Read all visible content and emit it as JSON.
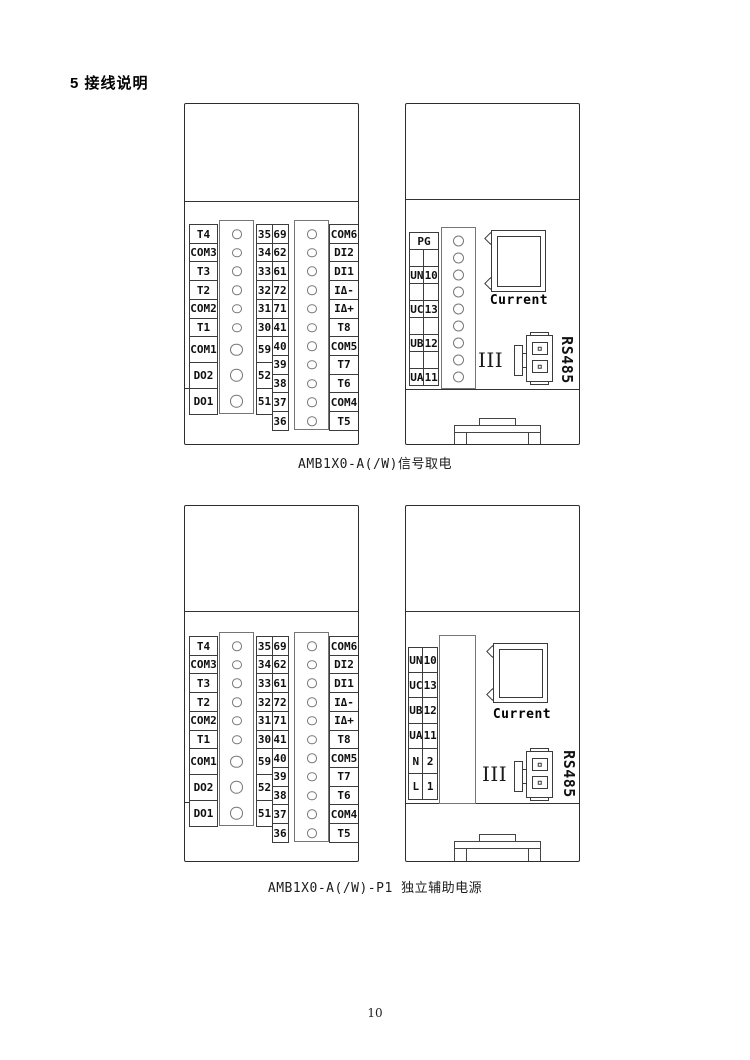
{
  "page": {
    "heading": "5 接线说明",
    "page_number": "10"
  },
  "captions": {
    "signal": "AMB1X0-A(/W)信号取电",
    "aux": "AMB1X0-A(/W)-P1 独立辅助电源"
  },
  "labels": {
    "current": "Current",
    "rs485": "RS485",
    "group": "III"
  },
  "colors": {
    "line": "#3c3c3c",
    "strip_line": "#757575",
    "text": "#111111",
    "background": "#ffffff"
  },
  "terminal_block": {
    "labels_left": [
      "T4",
      "COM3",
      "T3",
      "T2",
      "COM2",
      "T1",
      "COM1",
      "DO2",
      "DO1"
    ],
    "numbers_left": [
      "35",
      "34",
      "33",
      "32",
      "31",
      "30",
      "59",
      "52",
      "51"
    ],
    "numbers_right": [
      "69",
      "62",
      "61",
      "72",
      "71",
      "41",
      "40",
      "39",
      "38",
      "37",
      "36"
    ],
    "labels_right": [
      "COM6",
      "DI2",
      "DI1",
      "IΔ-",
      "IΔ+",
      "T8",
      "COM5",
      "T7",
      "T6",
      "COM4",
      "T5"
    ]
  },
  "signal_right": {
    "rows": [
      {
        "a": "PG",
        "b": ""
      },
      {
        "a": "",
        "b": ""
      },
      {
        "a": "UN",
        "b": "10"
      },
      {
        "a": "",
        "b": ""
      },
      {
        "a": "UC",
        "b": "13"
      },
      {
        "a": "",
        "b": ""
      },
      {
        "a": "UB",
        "b": "12"
      },
      {
        "a": "",
        "b": ""
      },
      {
        "a": "UA",
        "b": "11"
      }
    ]
  },
  "aux_right": {
    "rows": [
      {
        "a": "UN",
        "b": "10"
      },
      {
        "a": "UC",
        "b": "13"
      },
      {
        "a": "UB",
        "b": "12"
      },
      {
        "a": "UA",
        "b": "11"
      },
      {
        "a": "N",
        "b": "2"
      },
      {
        "a": "L",
        "b": "1"
      }
    ]
  }
}
